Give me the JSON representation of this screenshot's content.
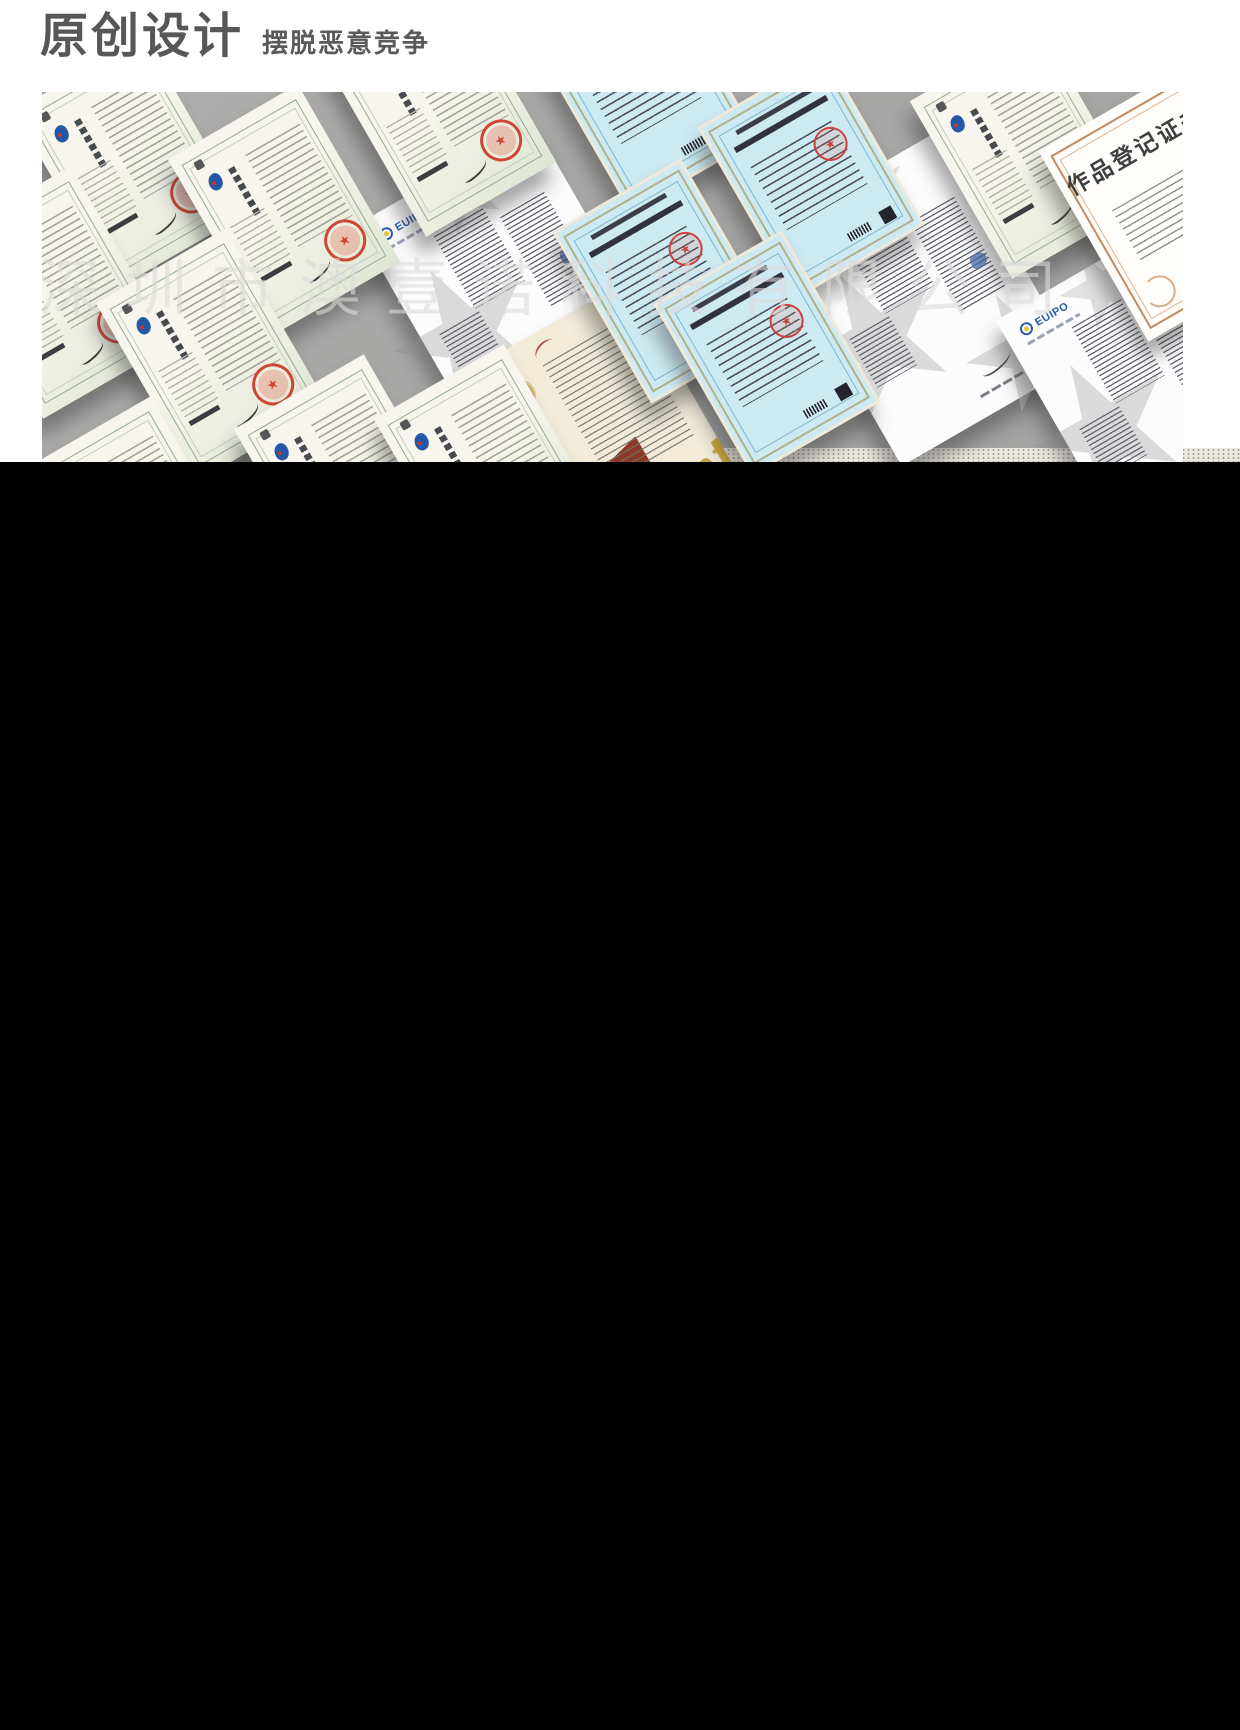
{
  "header": {
    "title": "原创设计",
    "subtitle": "摆脱恶意竞争"
  },
  "watermark": "深圳市澳壹诺科技有限公司",
  "labels": {
    "euipo_logo": "EUIPO",
    "patent_script": "Patent",
    "work_registration_title": "作品登记证书",
    "seal_star": "★"
  },
  "colors": {
    "header_text": "#57575a",
    "collage_background": "#a8a8a8",
    "seal_red": "#cf4536",
    "euipo_blue": "#2b5ca8",
    "patent_gold": "#c9a43e",
    "ribbon_red": "#8c3a27",
    "copyright_cert_cyan": "#cdeaf2",
    "dotted_strip": "#ebe8e1",
    "bottom_panel": "#000000"
  },
  "collage": {
    "rotation_deg": -30,
    "cards": [
      {
        "type": "euipo",
        "cx": 470,
        "cy": 200
      },
      {
        "type": "euipo",
        "cx": 880,
        "cy": 205
      },
      {
        "type": "euipo",
        "cx": 1110,
        "cy": 295
      },
      {
        "type": "gold",
        "cx": 565,
        "cy": 340
      },
      {
        "type": "blue",
        "cx": 600,
        "cy": -5
      },
      {
        "type": "blue",
        "cx": 766,
        "cy": 81
      },
      {
        "type": "blue",
        "cx": 621,
        "cy": 186
      },
      {
        "type": "blue",
        "cx": 722,
        "cy": 258
      },
      {
        "type": "cn",
        "cx": 88,
        "cy": 70
      },
      {
        "type": "cn",
        "cx": 242,
        "cy": 118
      },
      {
        "type": "cn",
        "cx": 398,
        "cy": 18
      },
      {
        "type": "cn",
        "cx": 15,
        "cy": 200
      },
      {
        "type": "cn",
        "cx": 170,
        "cy": 262
      },
      {
        "type": "cn",
        "cx": 95,
        "cy": 430
      },
      {
        "type": "cn",
        "cx": 308,
        "cy": 388
      },
      {
        "type": "cn",
        "cx": 448,
        "cy": 378
      },
      {
        "type": "cn",
        "cx": 984,
        "cy": 60
      },
      {
        "type": "zuopin",
        "cx": 1125,
        "cy": 112
      }
    ]
  }
}
